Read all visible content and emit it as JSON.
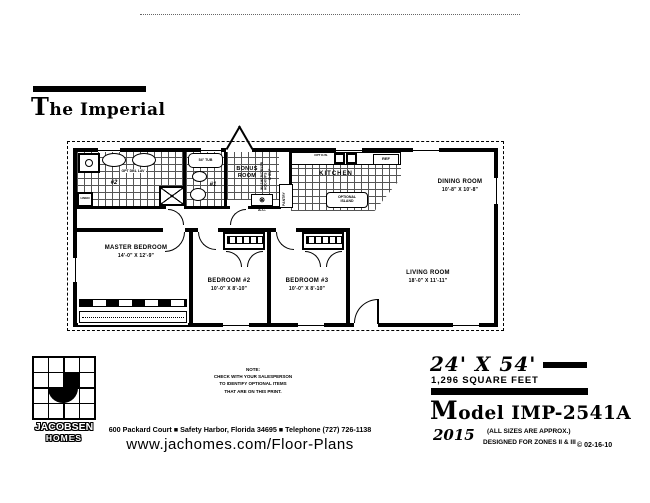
{
  "header": {
    "title_initial": "T",
    "title_rest": "he Imperial"
  },
  "plan": {
    "rooms": {
      "master": {
        "name": "MASTER BEDROOM",
        "dims": "14'-0\" X 12'-9\""
      },
      "bed2": {
        "name": "BEDROOM #2",
        "dims": "10'-0\" X 8'-10\""
      },
      "bed3": {
        "name": "BEDROOM #3",
        "dims": "10'-0\" X 8'-10\""
      },
      "living": {
        "name": "LIVING ROOM",
        "dims": "18'-0\" X 11'-11\""
      },
      "dining": {
        "name": "DINING ROOM",
        "dims": "10'-8\" X 10'-8\""
      },
      "kitchen": {
        "name": "KITCHEN"
      },
      "bonus": {
        "name": "BONUS ROOM"
      }
    },
    "labels": {
      "optional_island": "OPTIONAL ISLAND",
      "pantry": "PANTRY",
      "ref": "REF",
      "opt_dw": "OPT D.W.",
      "tub": "54\" TUB",
      "opt_dbl_lav": "OPT DBL LAV",
      "linen": "LINEN",
      "bath1": "#1",
      "bath2": "#2",
      "ac": "A.C.",
      "washer_dryer": "WASHER/DRYER HOOKUPS",
      "shelf": "SHELF"
    }
  },
  "note": {
    "line1": "NOTE:",
    "line2": "CHECK WITH YOUR SALESPERSON",
    "line3": "TO IDENTIFY OPTIONAL ITEMS",
    "line4": "THAT ARE ON THIS PRINT."
  },
  "logo": {
    "line1": "JACOBSEN",
    "line2": "HOMES"
  },
  "footer": {
    "address": "600 Packard Court ■ Safety Harbor, Florida 34695 ■ Telephone (727) 726-1138",
    "website": "www.jachomes.com/Floor-Plans"
  },
  "spec": {
    "dimensions": "24' X 54'",
    "sqft": "1,296 SQUARE FEET",
    "model_initial": "M",
    "model_rest": "odel IMP-2541A",
    "year": "2015",
    "approx": "(ALL SIZES ARE APPROX.)",
    "zones": "DESIGNED FOR ZONES II & III",
    "copyright": "© 02-16-10"
  }
}
